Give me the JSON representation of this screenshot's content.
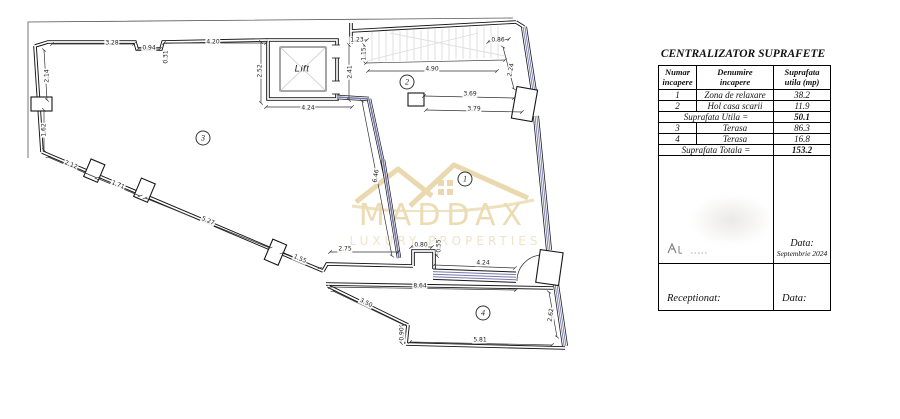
{
  "table": {
    "title": "CENTRALIZATOR SUPRAFETE",
    "headers": [
      {
        "line1": "Numar",
        "line2": "incapere"
      },
      {
        "line1": "Denumire",
        "line2": "incapere"
      },
      {
        "line1": "Suprafata",
        "line2": "utila (mp)"
      }
    ],
    "rows": [
      {
        "nr": "1",
        "name": "Zona de relaxare",
        "area": "38.2"
      },
      {
        "nr": "2",
        "name": "Hol casa scarii",
        "area": "11.9"
      }
    ],
    "subtotal": {
      "label": "Suprafata Utila =",
      "value": "50.1"
    },
    "rows2": [
      {
        "nr": "3",
        "name": "Terasa",
        "area": "86.3"
      },
      {
        "nr": "4",
        "name": "Terasa",
        "area": "16.8"
      }
    ],
    "total": {
      "label": "Suprafata Totala =",
      "value": "153.2"
    },
    "date_label": "Data:",
    "date_value": "Septembrie 2024",
    "received_label": "Receptionat:",
    "bottom_date_label": "Data:"
  },
  "watermark": {
    "name": "MADDAX",
    "tagline": "LUXURY PROPERTIES",
    "color": "#e9d6a6"
  },
  "plan": {
    "lift_label": "Lift",
    "colors": {
      "wall": "#1a1a1a",
      "glazing_blue": "#7478ad",
      "hatch_gray": "#cfcfcf"
    },
    "rooms": [
      {
        "n": "1",
        "x": 465,
        "y": 179
      },
      {
        "n": "2",
        "x": 407,
        "y": 82
      },
      {
        "n": "3",
        "x": 203,
        "y": 138
      },
      {
        "n": "4",
        "x": 483,
        "y": 313
      }
    ],
    "dims": [
      {
        "t": "3.28",
        "x": 112,
        "y": 43,
        "r": 0
      },
      {
        "t": "0.94",
        "x": 149,
        "y": 48,
        "r": 0
      },
      {
        "t": "0.31",
        "x": 166,
        "y": 57,
        "r": -90
      },
      {
        "t": "4.20",
        "x": 213,
        "y": 42,
        "r": 0
      },
      {
        "t": "2.14",
        "x": 47,
        "y": 76,
        "r": -90
      },
      {
        "t": "1.62",
        "x": 44,
        "y": 130,
        "r": -90
      },
      {
        "t": "2.52",
        "x": 260,
        "y": 71,
        "r": -90
      },
      {
        "t": "4.24",
        "x": 308,
        "y": 108,
        "r": 0
      },
      {
        "t": "2.41",
        "x": 350,
        "y": 72,
        "r": -90
      },
      {
        "t": "1.23",
        "x": 357,
        "y": 40,
        "r": 0
      },
      {
        "t": "1.15",
        "x": 364,
        "y": 54,
        "r": -90
      },
      {
        "t": "4.90",
        "x": 432,
        "y": 69,
        "r": 0
      },
      {
        "t": "0.86",
        "x": 498,
        "y": 40,
        "r": 0
      },
      {
        "t": "2.24",
        "x": 511,
        "y": 70,
        "r": -78
      },
      {
        "t": "3.69",
        "x": 470,
        "y": 94,
        "r": 0
      },
      {
        "t": "3.79",
        "x": 474,
        "y": 109,
        "r": 0
      },
      {
        "t": "6.46",
        "x": 376,
        "y": 176,
        "r": -80
      },
      {
        "t": "2.12",
        "x": 71,
        "y": 165,
        "r": 22
      },
      {
        "t": "1.71",
        "x": 118,
        "y": 185,
        "r": 22
      },
      {
        "t": "5.27",
        "x": 208,
        "y": 221,
        "r": 23
      },
      {
        "t": "1.55",
        "x": 300,
        "y": 259,
        "r": 23
      },
      {
        "t": "2.75",
        "x": 345,
        "y": 249,
        "r": 0
      },
      {
        "t": "0.80",
        "x": 421,
        "y": 245,
        "r": 0
      },
      {
        "t": "0.55",
        "x": 439,
        "y": 246,
        "r": -90
      },
      {
        "t": "4.24",
        "x": 483,
        "y": 263,
        "r": 0
      },
      {
        "t": "8.64",
        "x": 420,
        "y": 286,
        "r": 0
      },
      {
        "t": "3.50",
        "x": 366,
        "y": 303,
        "r": 26
      },
      {
        "t": "0.90",
        "x": 402,
        "y": 334,
        "r": -90
      },
      {
        "t": "5.81",
        "x": 480,
        "y": 340,
        "r": 0
      },
      {
        "t": "2.62",
        "x": 551,
        "y": 315,
        "r": -82
      }
    ]
  }
}
